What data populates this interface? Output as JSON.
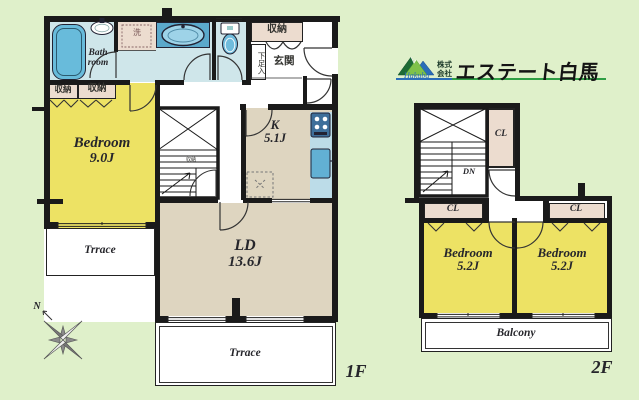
{
  "colors": {
    "background": "#dff0ca",
    "wall": "#1a1a1a",
    "bedroom_yellow": "#ede264",
    "living_beige": "#ded5c0",
    "closet_beige": "#ecdccf",
    "water_blue": "#cfe6ea",
    "fixture_blue": "#68bbdb",
    "counter_blue": "#bcdce8",
    "logo_green": "#2f9e44",
    "logo_blue": "#2a6db8"
  },
  "logo": {
    "prefix_top": "株式",
    "prefix_bottom": "会社",
    "name": "エステート白馬",
    "script": "Hakuba"
  },
  "floor1": {
    "label": "1F",
    "bathroom": "Bath room",
    "closet_left_1": "収納",
    "closet_left_2": "収納",
    "storage_top": "収納",
    "understair_storage": "収納",
    "entrance": "玄関",
    "shoe_cabinet": "下足入",
    "washer": "洗",
    "bedroom_name": "Bedroom",
    "bedroom_size": "9.0J",
    "kitchen_name": "K",
    "kitchen_size": "5.1J",
    "living_name": "LD",
    "living_size": "13.6J",
    "terrace_left": "Trrace",
    "terrace_bottom": "Trrace",
    "compass_north": "N"
  },
  "floor2": {
    "label": "2F",
    "down": "DN",
    "closet_top": "CL",
    "closet_left": "CL",
    "closet_right": "CL",
    "bedroom1_name": "Bedroom",
    "bedroom1_size": "5.2J",
    "bedroom2_name": "Bedroom",
    "bedroom2_size": "5.2J",
    "balcony": "Balcony"
  }
}
